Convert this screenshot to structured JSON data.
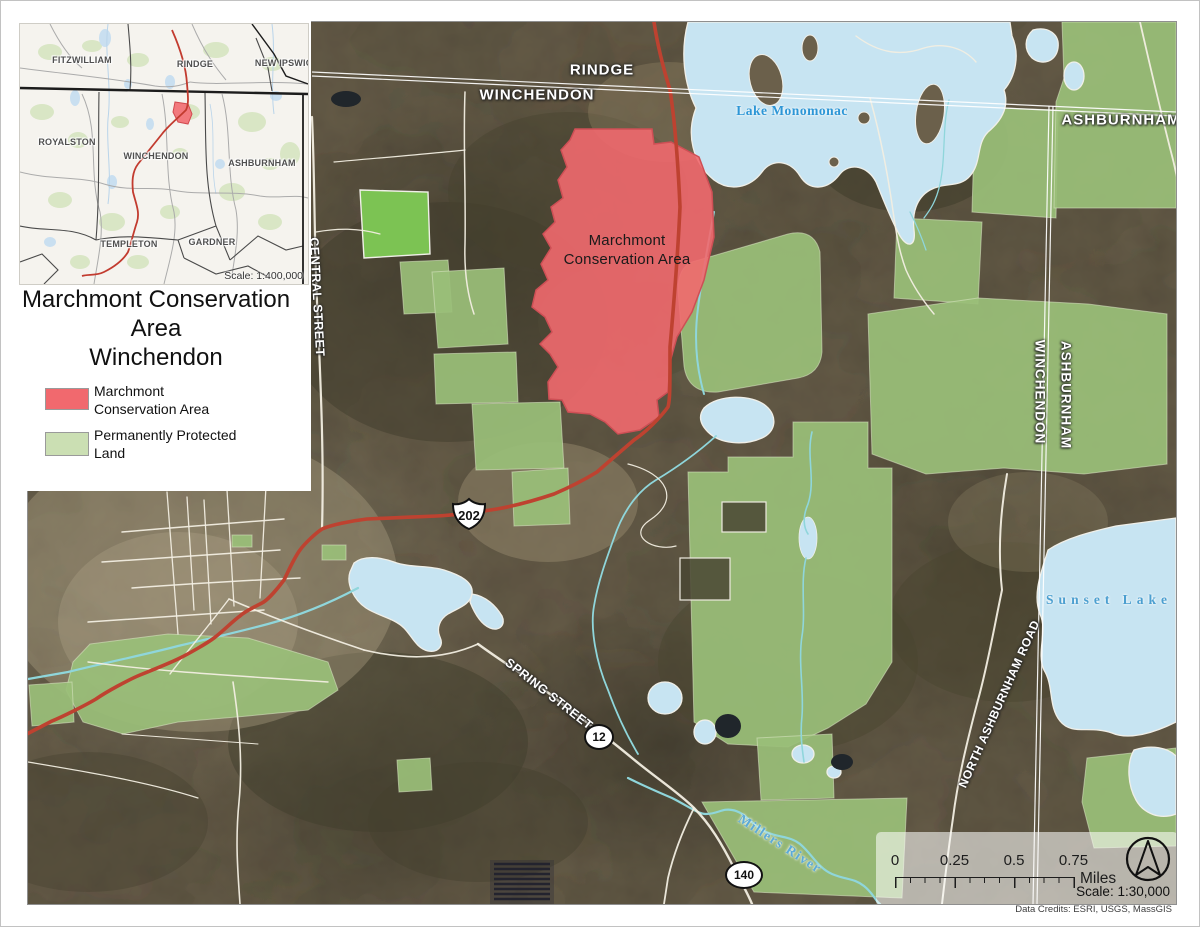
{
  "inset_map": {
    "towns": {
      "fitzwilliam": "FITZWILLIAM",
      "rindge": "RINDGE",
      "new_ipswich": "NEW\nIPSWICH",
      "royalston": "ROYALSTON",
      "winchendon": "WINCHENDON",
      "ashburnham": "ASHBURNHAM",
      "templeton": "TEMPLETON",
      "gardner": "GARDNER"
    },
    "scale_text": "Scale: 1:400,000"
  },
  "title_block": {
    "title": "Marchmont Conservation\nArea\nWinchendon"
  },
  "legend": {
    "item1": {
      "label": "Marchmont\nConservation Area",
      "color": "#F1696E"
    },
    "item2": {
      "label": "Permanently Protected\nLand",
      "color": "#CBDFB3"
    }
  },
  "map": {
    "town_labels": {
      "rindge": "RINDGE",
      "winchendon": "WINCHENDON",
      "ashburnham_ne": "ASHBURNHAM",
      "winchendon_boundary": "WINCHENDON",
      "ashburnham_boundary": "ASHBURNHAM"
    },
    "water_labels": {
      "lake_monomonac": "Lake Monomonac",
      "sunset_lake": "Sunset Lake",
      "millers_river": "Millers River"
    },
    "road_labels": {
      "central_street": "CENTRAL STREET",
      "spring_street": "SPRING STREET",
      "north_ashburnham_road": "NORTH ASHBURNHAM ROAD"
    },
    "route_shields": {
      "us202": "202",
      "sr12": "12",
      "sr140": "140"
    },
    "area_label": "Marchmont\nConservation Area",
    "scalebar": {
      "tick_labels": [
        "0",
        "0.25",
        "0.5",
        "0.75"
      ],
      "unit": "Miles",
      "scale_text": "Scale: 1:30,000"
    },
    "credits": "Data Credits: ESRI, USGS, MassGIS"
  },
  "colors": {
    "conservation_fill": "#F1696E",
    "protected_fill": "#9ABE78",
    "water_fill": "#C7E4F2",
    "highway_red": "#BE4230"
  }
}
